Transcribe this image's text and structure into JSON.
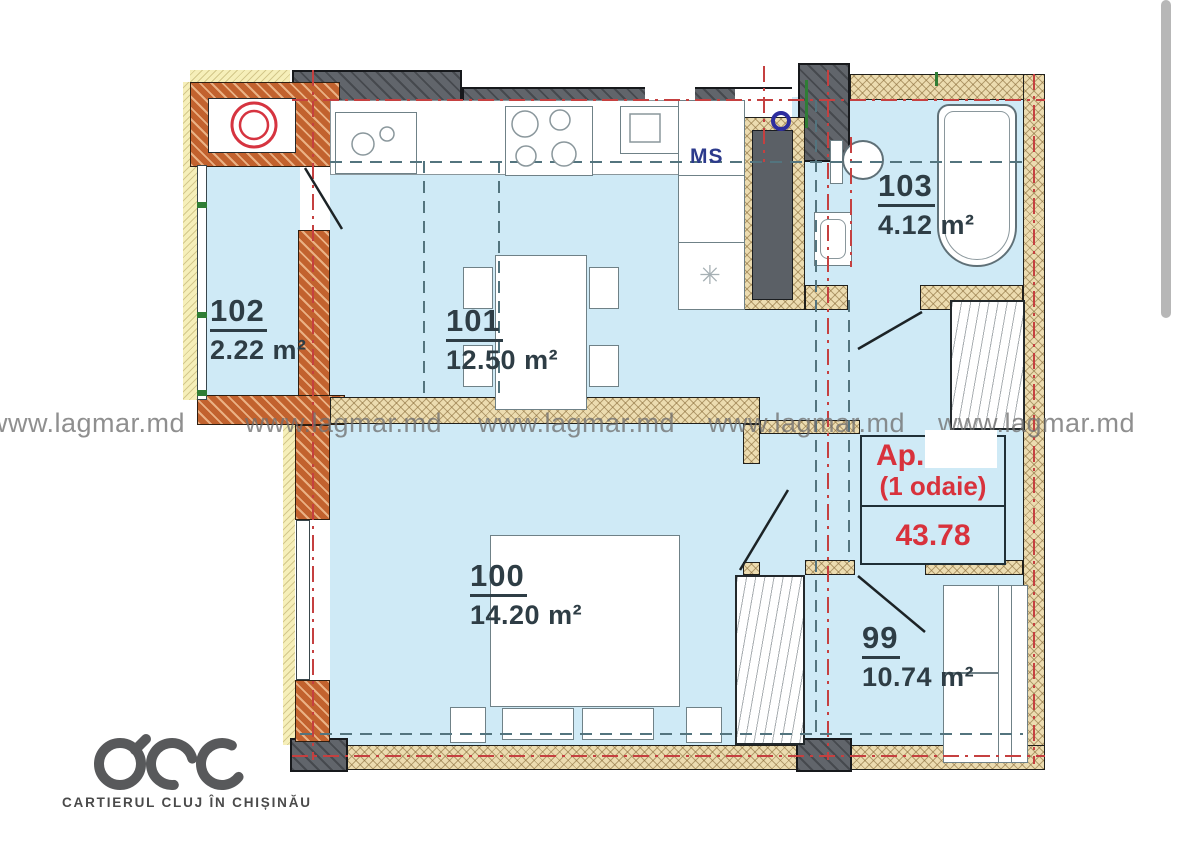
{
  "watermark": {
    "items": [
      "www.lagmar.md",
      "www.lagmar.md",
      "www.lagmar.md",
      "www.lagmar.md",
      "www.lagmar.md"
    ]
  },
  "plan": {
    "rooms": {
      "r102": {
        "number": "102",
        "area": "2.22 m²"
      },
      "r101": {
        "number": "101",
        "area": "12.50 m²"
      },
      "r103": {
        "number": "103",
        "area": "4.12 m²"
      },
      "r100": {
        "number": "100",
        "area": "14.20 m²"
      },
      "r99": {
        "number": "99",
        "area": "10.74 m²"
      }
    },
    "shaft_label": "MS",
    "fridge_glyph": "✳",
    "apartment_box": {
      "prefix": "Ap.",
      "type_label": "(1 odaie)",
      "total_area": "43.78"
    }
  },
  "logo": {
    "caption": "CARTIERUL CLUJ ÎN CHIȘINĂU"
  },
  "colors": {
    "room_fill": "#cfeaf6",
    "wall_orange": "#c2622e",
    "wall_dark": "#61656b",
    "wall_beige": "#ecdcb0",
    "insulation_yellow": "#f6efb9",
    "centerline_red": "#c54040",
    "dashed_teal": "#53747e",
    "label_ink": "#2e3d45",
    "accent_red": "#d8323c",
    "ms_blue": "#2c3a8c",
    "watermark_gray": "#707070"
  }
}
